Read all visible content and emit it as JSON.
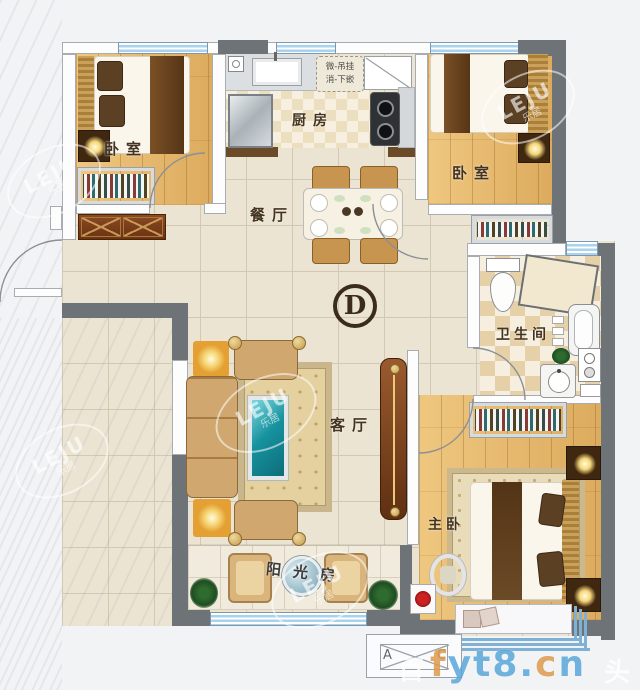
{
  "rooms": {
    "bedroom_top_left": {
      "label": "卧室"
    },
    "kitchen": {
      "label": "厨房"
    },
    "bedroom_top_right": {
      "label": "卧室"
    },
    "dining": {
      "label": "餐厅"
    },
    "living": {
      "label": "客厅"
    },
    "bathroom": {
      "label": "卫生间"
    },
    "master_bedroom": {
      "label": "主卧"
    },
    "sunroom": {
      "label": "阳光房"
    }
  },
  "annotations": {
    "unit_marker": "D",
    "kitchen_note_line1": "微-吊挂",
    "kitchen_note_line2": "消-下嵌",
    "compass_a": "A",
    "compass_c": "C"
  },
  "watermarks": {
    "leju_text": "LEJU",
    "leju_cn": "乐居",
    "site_letters": [
      {
        "ch": "f",
        "color": "#dd9a4e"
      },
      {
        "ch": "y",
        "color": "#5aa7da"
      },
      {
        "ch": "t",
        "color": "#5aa7da"
      },
      {
        "ch": "8",
        "color": "#5aa7da"
      },
      {
        "ch": ".",
        "color": "#5aa7da"
      },
      {
        "ch": "c",
        "color": "#dd9a4e"
      },
      {
        "ch": "n",
        "color": "#5aa7da"
      }
    ],
    "faint_left": "百",
    "faint_right": "头"
  },
  "colors": {
    "wall": "#6e7377",
    "window": "#a9d2ee",
    "tile_line": "#d3c9b2",
    "tile_bg": "#ebe4d2",
    "checker_dark": "#e5d0a8",
    "checker_light": "#f6efdf",
    "label_ink": "#44331f",
    "marker_ink": "#3b2b1b"
  }
}
